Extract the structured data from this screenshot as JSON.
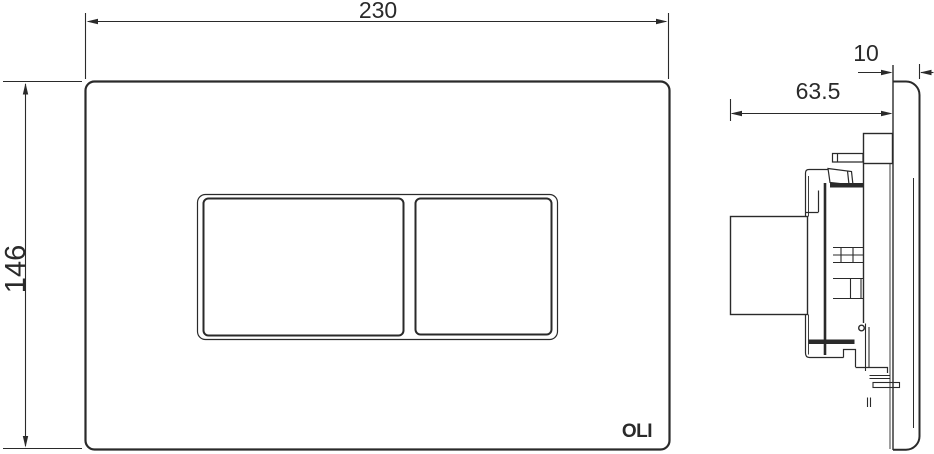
{
  "front_view": {
    "width_label": "230",
    "height_label": "146",
    "logo_text": "OLI"
  },
  "side_view": {
    "thickness_label": "10",
    "depth_label": "63.5"
  },
  "colors": {
    "line": "#2a2a2a",
    "background": "#ffffff"
  }
}
